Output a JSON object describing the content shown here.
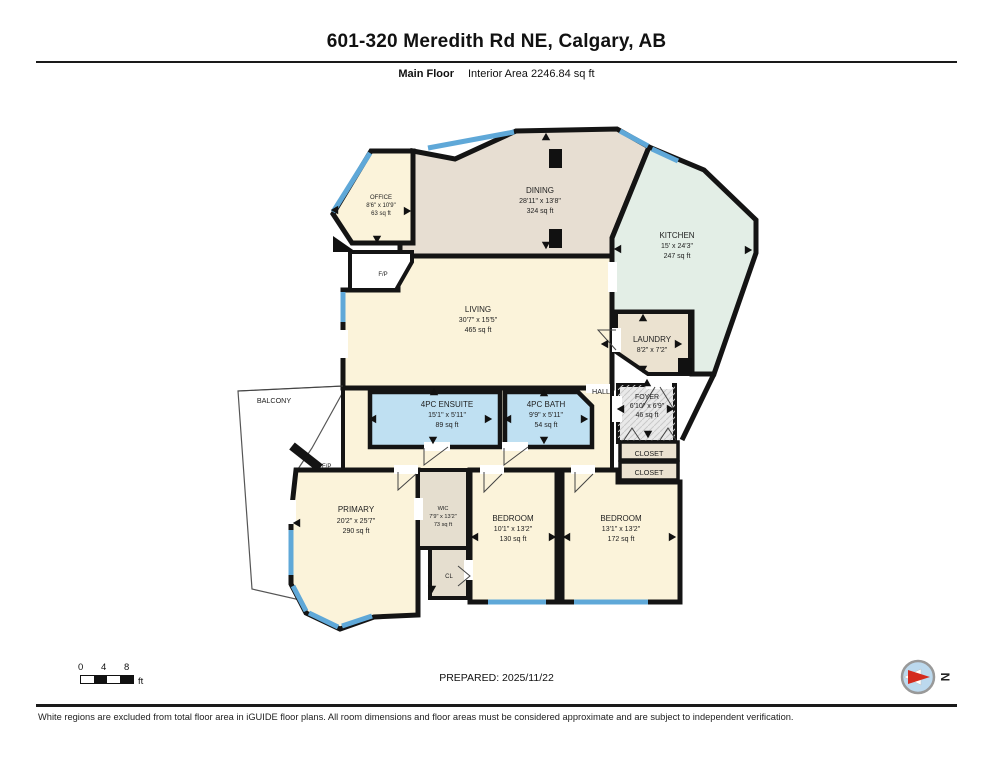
{
  "header": {
    "title": "601-320 Meredith Rd NE, Calgary, AB",
    "floor_label": "Main Floor",
    "area_label": "Interior Area 2246.84 sq ft"
  },
  "rooms": {
    "office": {
      "name": "OFFICE",
      "dims": "8'6\" x 10'9\"",
      "area": "63 sq ft"
    },
    "dining": {
      "name": "DINING",
      "dims": "28'11\" x 13'8\"",
      "area": "324 sq ft"
    },
    "kitchen": {
      "name": "KITCHEN",
      "dims": "15' x 24'3\"",
      "area": "247 sq ft"
    },
    "living": {
      "name": "LIVING",
      "dims": "30'7\" x 15'5\"",
      "area": "465 sq ft"
    },
    "laundry": {
      "name": "LAUNDRY",
      "dims": "8'2\" x 7'2\"",
      "area": ""
    },
    "foyer": {
      "name": "FOYER",
      "dims": "6'10\" x 6'9\"",
      "area": "46 sq ft"
    },
    "ensuite": {
      "name": "4PC ENSUITE",
      "dims": "15'1\" x 5'11\"",
      "area": "89 sq ft"
    },
    "bath": {
      "name": "4PC BATH",
      "dims": "9'9\" x 5'11\"",
      "area": "54 sq ft"
    },
    "primary": {
      "name": "PRIMARY",
      "dims": "20'2\" x 25'7\"",
      "area": "290 sq ft"
    },
    "wic": {
      "name": "WIC",
      "dims": "7'9\" x 13'2\"",
      "area": "73 sq ft"
    },
    "bedroom1": {
      "name": "BEDROOM",
      "dims": "10'1\" x 13'2\"",
      "area": "130 sq ft"
    },
    "bedroom2": {
      "name": "BEDROOM",
      "dims": "13'1\" x 13'2\"",
      "area": "172 sq ft"
    }
  },
  "labels": {
    "hall": "HALL",
    "balcony": "BALCONY",
    "closet_top": "CLOSET",
    "closet_bottom": "CLOSET",
    "cl": "CL",
    "fp_living": "F/P",
    "fp_primary": "F/P"
  },
  "scale_bar": {
    "tick0": "0",
    "tick1": "4",
    "tick2": "8",
    "unit": "ft"
  },
  "compass": {
    "north": "N"
  },
  "footer": {
    "prepared": "PREPARED: 2025/11/22",
    "disclaimer": "White regions are excluded from total floor area in iGUIDE floor plans. All room dimensions and floor areas must be considered approximate and are subject to independent verification."
  },
  "colors": {
    "wall": "#141414",
    "window": "#5FA8D8",
    "window_light": "#9FD0EC",
    "cream": "#FBF3DA",
    "tan": "#E7DED2",
    "mint": "#E3EEE6",
    "bath_blue": "#BFE0F2",
    "beige": "#EBE2D0",
    "gray": "#E9E9E9",
    "wic_gray": "#E5DECF",
    "white": "#FFFFFF",
    "compass_blue": "#BCD9EE",
    "compass_red": "#D42B1E",
    "black": "#111111"
  }
}
